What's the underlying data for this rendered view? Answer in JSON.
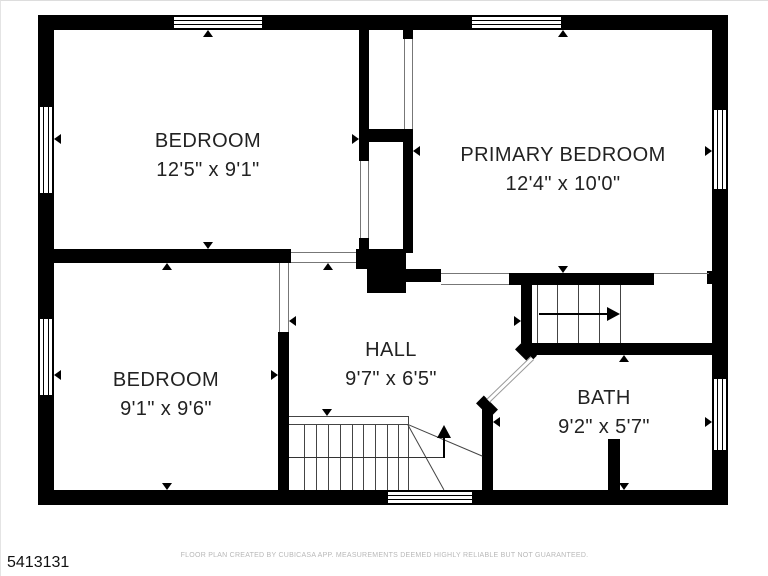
{
  "plan": {
    "id": "5413131",
    "disclaimer": "FLOOR PLAN CREATED BY CUBICASA APP. MEASUREMENTS DEEMED HIGHLY RELIABLE BUT NOT GUARANTEED.",
    "rooms": [
      {
        "name": "BEDROOM",
        "dims": "12'5\" x 9'1\""
      },
      {
        "name": "PRIMARY BEDROOM",
        "dims": "12'4\" x 10'0\""
      },
      {
        "name": "BEDROOM",
        "dims": "9'1\" x 9'6\""
      },
      {
        "name": "HALL",
        "dims": "9'7\" x 6'5\""
      },
      {
        "name": "BATH",
        "dims": "9'2\" x 5'7\""
      }
    ],
    "colors": {
      "wall": "#000000",
      "room_text": "#222222",
      "thin_line": "#777777",
      "stair_line": "#444444",
      "disclaimer_text": "#b8b8b8",
      "background": "#ffffff"
    }
  }
}
